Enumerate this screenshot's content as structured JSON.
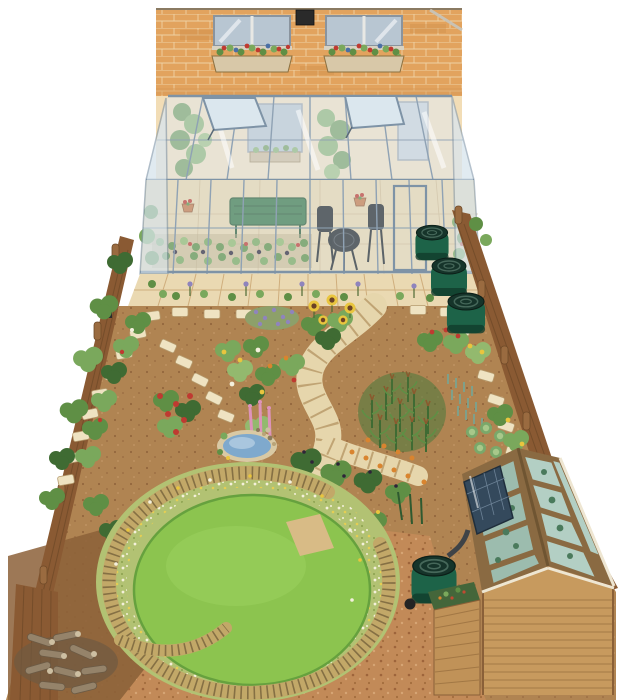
{
  "meta": {
    "title": "Watercolour garden plan: brick house with lean-to conservatory, flower and vegetable beds, circular lawn with woven willow spiral, shed with glazed roof and solar panel",
    "canvas": {
      "width": 620,
      "height": 700
    },
    "background": "#ffffff"
  },
  "palette": {
    "brick": "#e2a35e",
    "mortar": "#f3ddb4",
    "wall_inside": "#f2ddb6",
    "roof_glass": "#dfeaf2",
    "glass": "#d8e6ee",
    "frame": "#7e93a6",
    "patio": "#ead9b2",
    "floor": "#ead7b0",
    "soil": "#b08452",
    "soil_dark": "#8c6038",
    "stone": "#efe3c2",
    "path": "#e6d6ac",
    "path_joint": "#c0a474",
    "lawn": "#8cc44f",
    "lawn_edge": "#66a13e",
    "meadow": "#b2c273",
    "willow": "#c2a868",
    "willow_weave": "#857044",
    "fence": "#8a5a33",
    "fence_dark": "#6f4a28",
    "water_butt": "#1d6348",
    "butt_lid": "#16342a",
    "pond": "#7fa9cd",
    "pond_light": "#a9c6de",
    "gravel": "#c28a58",
    "shed_wood": "#c79a5e",
    "solar_panel": "#34495c",
    "bench": "#3e7a4b",
    "terracotta": "#c77a4a",
    "flower_red": "#bf3a31",
    "flower_yellow": "#e9c53e",
    "flower_orange": "#d9842f",
    "flower_purple": "#8f84bd",
    "flower_pink": "#dd93bb",
    "flower_blue": "#4a6fa5",
    "log": "#95836a"
  },
  "scene": {
    "house": {
      "label": "brick house wall",
      "windows": 2,
      "window_boxes": 2,
      "wall_lights": 1
    },
    "conservatory": {
      "label": "lean-to glass conservatory",
      "open_roof_vents": 2,
      "bistro_set": "round table with two chairs",
      "bench": "green potting bench",
      "staging": "seed trays with aubergine and tomato plants",
      "hanging_pots": 2,
      "door": 1
    },
    "patio": {
      "label": "paved patio"
    },
    "water_butts": {
      "label": "green water butts by right fence",
      "count": 3
    },
    "garden": {
      "paths": "curving slab path with stepping-stone trails",
      "pond": "small pebble-edged pond",
      "beds": [
        "allium border",
        "lavender",
        "sunflowers",
        "mixed cottage flowers",
        "red roses",
        "pink spires",
        "sweetcorn patch",
        "leek rows",
        "cabbages",
        "squash",
        "berry bushes",
        "marigold edging"
      ]
    },
    "lawn": {
      "label": "circular lawn",
      "surround": "woven willow spiral screen",
      "ring": "wildflower meadow ring"
    },
    "log_pile": {
      "label": "log pile in bottom-left corner"
    },
    "shed": {
      "label": "timber shed with glazed roof",
      "solar_panels": 1,
      "downpipe_to_water_butt": 1,
      "compost_bin": 1,
      "spare_wheel": 1
    },
    "fences": {
      "left": "timber fence with climbing plants and nest box",
      "right": "timber fence with posts"
    }
  }
}
